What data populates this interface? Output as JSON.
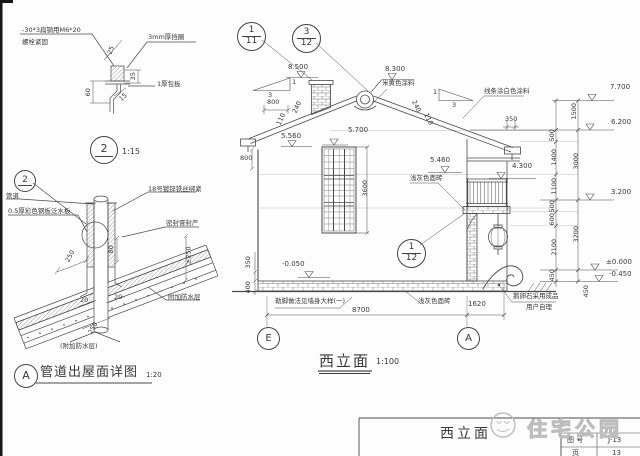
{
  "detail2": {
    "note_bolt_line1": "-30*3扁钢用M6*20",
    "note_bolt_line2": "螺栓紧固",
    "note_washer": "3mm厚挡圈",
    "note_plate": "1厚包板",
    "dim_25": "25",
    "dim_35": "35",
    "dim_60": "60",
    "dim_15": "15",
    "ref_number": "2",
    "scale": "1:15"
  },
  "detail_a": {
    "ref_number": "2",
    "note_pipe": "管道",
    "note_flashing": "0.5厚彩色钢板泛水板",
    "note_wire": "18号镀锌铁丝绑紧",
    "note_sealant": "密封膏封严",
    "dim_ge250": "≥250",
    "dim_250_roof": "250",
    "dim_80": "80",
    "dim_20_left": "20",
    "dim_20_right": "20",
    "dim_250_pipe": "250",
    "note_added_wp_paren": "(附加防水层)",
    "note_added_wp": "附加防水层",
    "title_letter": "A",
    "title": "管道出屋面详图",
    "scale": "1:20"
  },
  "elevation": {
    "refs": {
      "r111_top": "1",
      "r111_bot": "11",
      "r312_top": "3",
      "r312_bot": "12",
      "r112_top": "1",
      "r112_bot": "12"
    },
    "levels": {
      "l8500": "8.500",
      "l8300": "8.300",
      "l5560": "5.560",
      "l5700": "5.700",
      "l5460": "5.460",
      "l4300": "4.300",
      "lm0050": "-0.050",
      "l7700": "7.700",
      "l6200": "6.200",
      "l3200": "3.200",
      "l0000": "±0.000",
      "lm0450": "-0.450"
    },
    "dims": {
      "roof_800": "800",
      "wall_800": "800",
      "left_240": "240",
      "left_110": "110",
      "right_240": "240",
      "right_110": "110",
      "eave_350": "350",
      "win_3600": "3600",
      "base_350": "350",
      "base_400": "400",
      "span_8700": "8700",
      "span_1620": "1620",
      "r_1500": "1500",
      "r_500a": "500",
      "r_1400": "1400",
      "r_1100": "1100",
      "r_500b": "500",
      "r_600": "600",
      "r_2100": "2100",
      "r_450a": "450",
      "r_3000": "3000",
      "r_3200": "3200",
      "r_450b": "450"
    },
    "slopes": {
      "left_rise": "1",
      "left_run": "3",
      "right_rise": "1",
      "right_run": "3"
    },
    "notes": {
      "paint_beige": "米黄色涂料",
      "trim_white": "线条涂白色涂料",
      "tile_upper": "浅灰色面砖",
      "tile_lower": "浅灰色面砖",
      "plinth": "勒脚做法见墙身大样(一)",
      "cobble1": "鹅卵石采用成品",
      "cobble2": "用户自理"
    },
    "grid": {
      "e": "E",
      "a": "A"
    },
    "title": "西立面",
    "scale": "1:100"
  },
  "titleblock": {
    "drawing_name": "西立面",
    "row1_label": "图 号",
    "row1_value": "J-13",
    "row2_label": "页",
    "row2_value": "13"
  },
  "watermark": {
    "text": "住宅公园"
  }
}
